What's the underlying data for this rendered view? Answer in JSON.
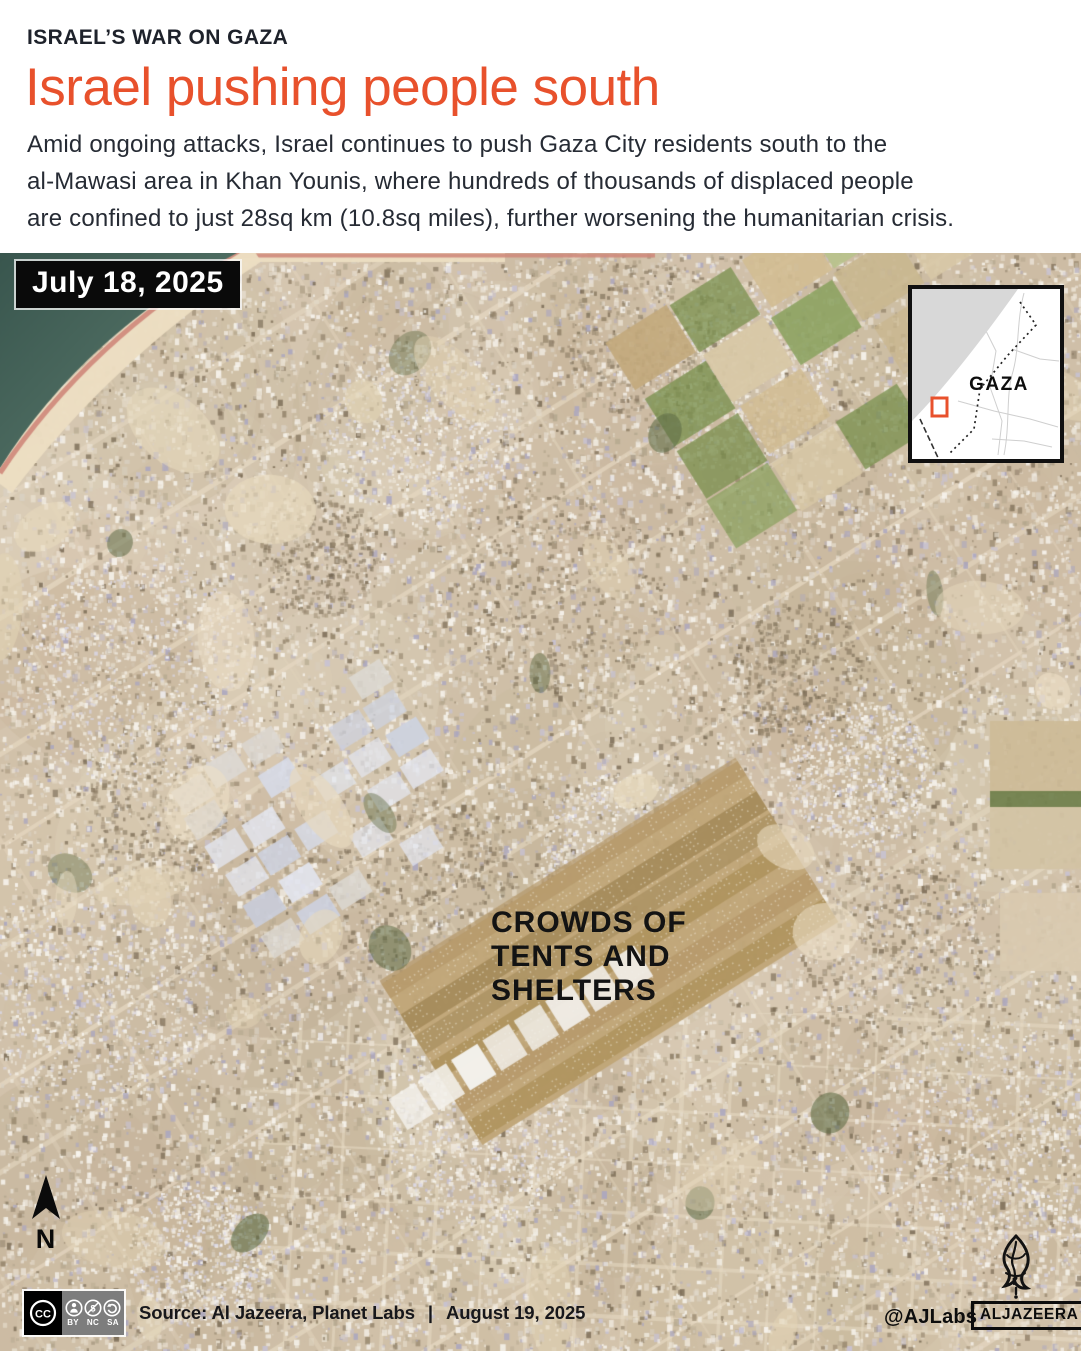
{
  "header": {
    "kicker": "ISRAEL’S WAR ON GAZA",
    "title": "Israel pushing people south",
    "description_lines": [
      "Amid ongoing attacks, Israel continues to push Gaza City residents south to the",
      "al-Mawasi area in Khan Younis, where hundreds of thousands of displaced people",
      "are confined to just 28sq km (10.8sq miles), further worsening the humanitarian crisis."
    ]
  },
  "map": {
    "date_badge": "July 18, 2025",
    "annotation_lines": [
      "CROWDS OF",
      "TENTS AND",
      "SHELTERS"
    ],
    "north_label": "N",
    "inset": {
      "region_label": "GAZA"
    },
    "colors": {
      "accent": "#e8512c",
      "sea": "#44615a",
      "beach": "#ecdec2",
      "coast_road": "#cf897c",
      "land": "#d3c4ae",
      "field_green": "#7b9150",
      "inset_sea": "#d8d8d8"
    }
  },
  "footer": {
    "license": {
      "cc": "CC",
      "labels": [
        "BY",
        "NC",
        "SA"
      ]
    },
    "source_label": "Source: Al Jazeera, Planet Labs",
    "separator": "|",
    "published_date": "August 19, 2025",
    "credit": "@AJLabs",
    "brand": "ALJAZEERA"
  }
}
